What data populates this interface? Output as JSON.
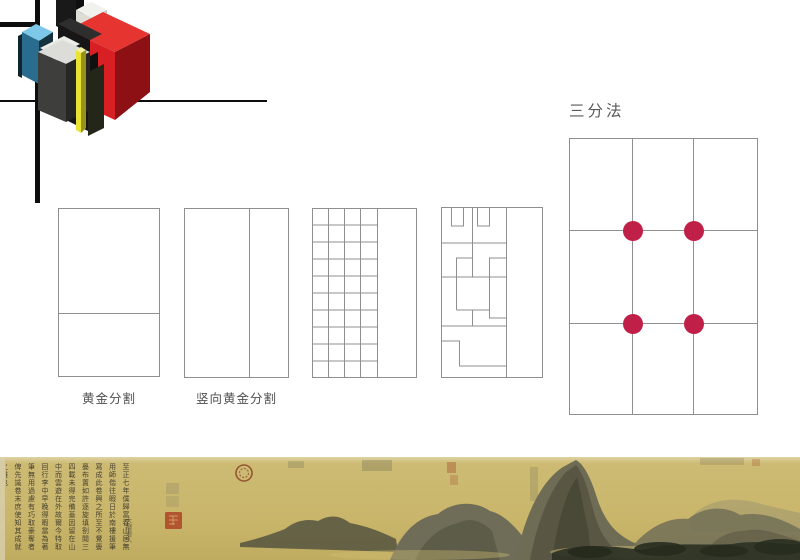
{
  "slide": {
    "labels": {
      "golden_horizontal": "黄金分割",
      "golden_vertical": "竖向黄金分割",
      "thirds_title": "三分法"
    },
    "colors": {
      "mondrian_line": "#0d0d0d",
      "diagram_line": "#8f8f8f",
      "label_text": "#4f4f4f",
      "thirds_dot": "#c01f48"
    }
  },
  "logo": {
    "description": "isometric-blocks-logo",
    "colors": {
      "red_top": "#e63531",
      "red_front": "#d71f24",
      "red_side": "#8c1014",
      "blue_top": "#7dc8e9",
      "blue_front": "#2a6c8d",
      "blue_side": "#16323f",
      "yellow": "#e9e431",
      "yellow_side": "#97931a",
      "gray_top": "#dcdcd8",
      "gray_front": "#3e3e3c",
      "black": "#161616",
      "white": "#f1f1ed"
    }
  },
  "painting": {
    "background": "#c9b66b",
    "ink": "#3d382a",
    "seal_red": "#b14c2c",
    "inscription": "至正七年僕歸富春山居無用師偕往暇日於南樓援筆寫成此卷興之所至不覺亹亹布置如許逐旋填劄閱三四載未得完備蓋因留在山中而雲遊在外故爾今特取回行李中早晚得暇當為著筆無用過慮有巧取豪奪者俾先識卷末庶使知其成就之難也",
    "signature": "大癡道人"
  }
}
